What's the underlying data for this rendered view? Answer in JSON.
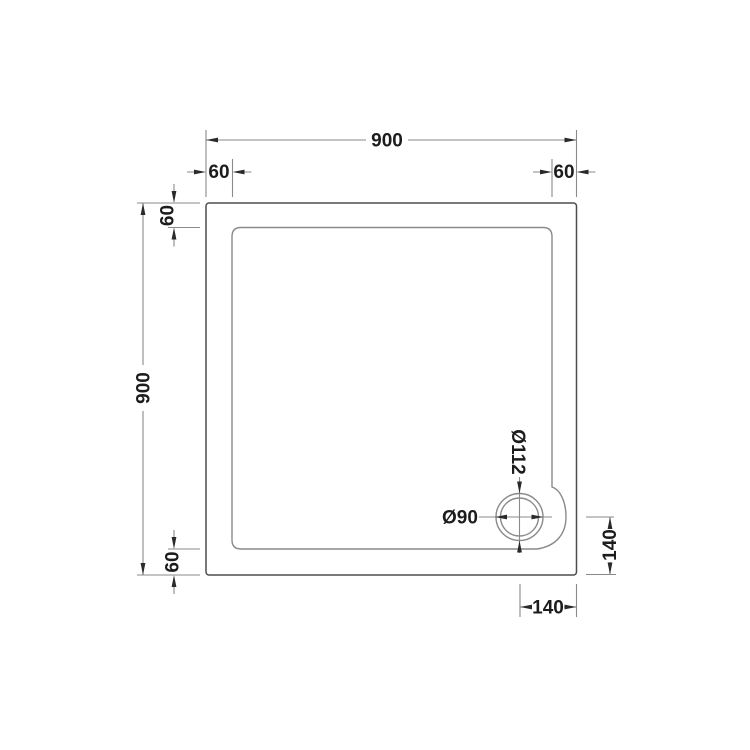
{
  "drawing": {
    "type": "technical-dimension-drawing",
    "subject": "Square shower tray, plan view with offset corner waste drain",
    "units": "mm",
    "colors": {
      "background": "#ffffff",
      "outline_dark": "#4d4d4d",
      "line_medium": "#8a8a8a",
      "text": "#1c1c1c"
    },
    "dimensions": {
      "overall_width": "900",
      "overall_height": "900",
      "rim_top_left": "60",
      "rim_top_right": "60",
      "rim_left_top": "60",
      "rim_left_bottom": "60",
      "drain_center_from_right_edge": "140",
      "drain_center_from_bottom_edge": "140",
      "drain_outer_diameter": "Ø112",
      "drain_hole_diameter": "Ø90"
    }
  }
}
